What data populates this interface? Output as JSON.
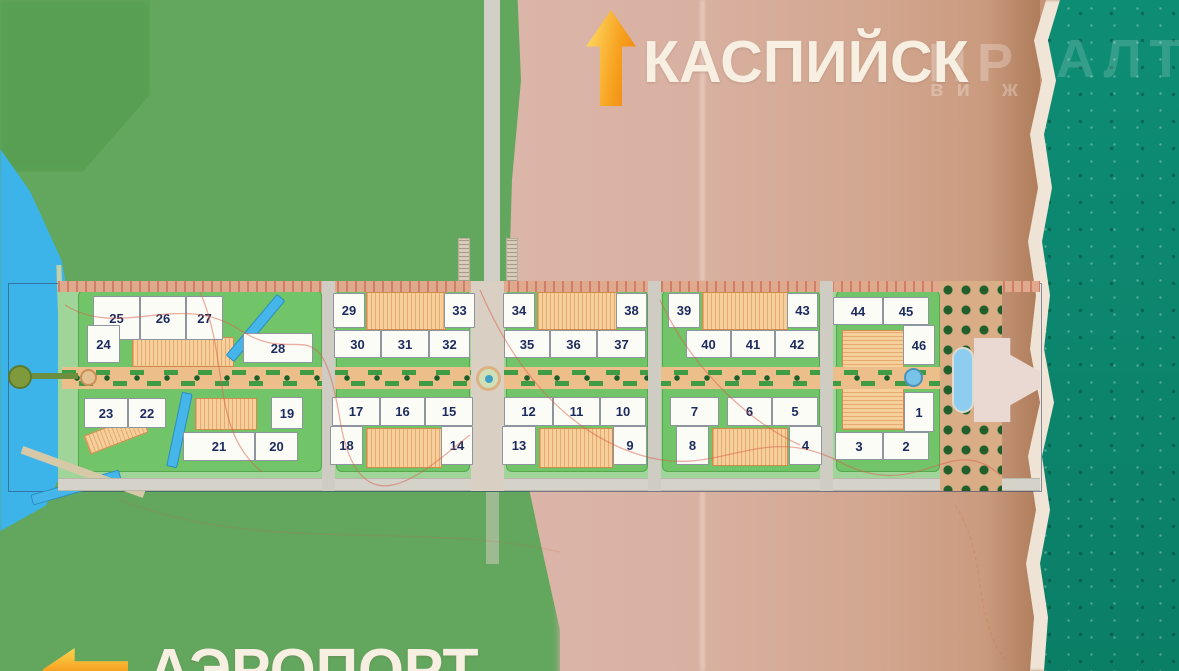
{
  "directions": {
    "north_label": "КАСПИЙСК",
    "south_label": "АЭРОПОРТ"
  },
  "watermark": {
    "part1": "НР",
    "part2": "АЛТ",
    "part3": "ви ж"
  },
  "colors": {
    "arrow_orange": "#f7941e",
    "label_text": "#f7f0e2",
    "number_navy": "#1c2a5e",
    "sea_teal": "#0d8570",
    "lake_cyan": "#3cb3e9",
    "grass_green": "#63a65e",
    "sand_pink": "#d9b1a2",
    "pad_green": "#72c468",
    "courtyard_tan": "#f6cf9b"
  },
  "plan": {
    "description": "seaside residential masterplan with numbered buildings",
    "building_count": 46,
    "buildings": [
      {
        "n": "25",
        "x": 93,
        "y": 296,
        "w": 47,
        "h": 44
      },
      {
        "n": "26",
        "x": 140,
        "y": 296,
        "w": 46,
        "h": 44
      },
      {
        "n": "27",
        "x": 186,
        "y": 296,
        "w": 37,
        "h": 44
      },
      {
        "n": "24",
        "x": 87,
        "y": 325,
        "w": 33,
        "h": 38
      },
      {
        "n": "28",
        "x": 243,
        "y": 333,
        "w": 70,
        "h": 30
      },
      {
        "n": "23",
        "x": 84,
        "y": 398,
        "w": 44,
        "h": 30
      },
      {
        "n": "22",
        "x": 128,
        "y": 398,
        "w": 38,
        "h": 30
      },
      {
        "n": "19",
        "x": 271,
        "y": 397,
        "w": 32,
        "h": 32
      },
      {
        "n": "21",
        "x": 183,
        "y": 432,
        "w": 72,
        "h": 29
      },
      {
        "n": "20",
        "x": 255,
        "y": 432,
        "w": 43,
        "h": 29
      },
      {
        "n": "29",
        "x": 333,
        "y": 293,
        "w": 32,
        "h": 35
      },
      {
        "n": "33",
        "x": 444,
        "y": 293,
        "w": 31,
        "h": 35
      },
      {
        "n": "30",
        "x": 334,
        "y": 330,
        "w": 47,
        "h": 28
      },
      {
        "n": "31",
        "x": 381,
        "y": 330,
        "w": 48,
        "h": 28
      },
      {
        "n": "32",
        "x": 429,
        "y": 330,
        "w": 41,
        "h": 28
      },
      {
        "n": "17",
        "x": 332,
        "y": 397,
        "w": 48,
        "h": 29
      },
      {
        "n": "16",
        "x": 380,
        "y": 397,
        "w": 45,
        "h": 29
      },
      {
        "n": "15",
        "x": 425,
        "y": 397,
        "w": 48,
        "h": 29
      },
      {
        "n": "18",
        "x": 330,
        "y": 426,
        "w": 33,
        "h": 39
      },
      {
        "n": "14",
        "x": 441,
        "y": 426,
        "w": 32,
        "h": 39
      },
      {
        "n": "34",
        "x": 503,
        "y": 293,
        "w": 32,
        "h": 35
      },
      {
        "n": "38",
        "x": 616,
        "y": 293,
        "w": 31,
        "h": 35
      },
      {
        "n": "35",
        "x": 504,
        "y": 330,
        "w": 46,
        "h": 28
      },
      {
        "n": "36",
        "x": 550,
        "y": 330,
        "w": 47,
        "h": 28
      },
      {
        "n": "37",
        "x": 597,
        "y": 330,
        "w": 49,
        "h": 28
      },
      {
        "n": "12",
        "x": 504,
        "y": 397,
        "w": 49,
        "h": 29
      },
      {
        "n": "11",
        "x": 553,
        "y": 397,
        "w": 47,
        "h": 29
      },
      {
        "n": "10",
        "x": 600,
        "y": 397,
        "w": 46,
        "h": 29
      },
      {
        "n": "13",
        "x": 502,
        "y": 426,
        "w": 34,
        "h": 39
      },
      {
        "n": "9",
        "x": 613,
        "y": 426,
        "w": 34,
        "h": 39
      },
      {
        "n": "39",
        "x": 668,
        "y": 293,
        "w": 32,
        "h": 35
      },
      {
        "n": "43",
        "x": 787,
        "y": 293,
        "w": 31,
        "h": 35
      },
      {
        "n": "40",
        "x": 686,
        "y": 330,
        "w": 45,
        "h": 28
      },
      {
        "n": "41",
        "x": 731,
        "y": 330,
        "w": 44,
        "h": 28
      },
      {
        "n": "42",
        "x": 775,
        "y": 330,
        "w": 44,
        "h": 28
      },
      {
        "n": "7",
        "x": 670,
        "y": 397,
        "w": 49,
        "h": 29
      },
      {
        "n": "6",
        "x": 727,
        "y": 397,
        "w": 45,
        "h": 29
      },
      {
        "n": "5",
        "x": 772,
        "y": 397,
        "w": 46,
        "h": 29
      },
      {
        "n": "8",
        "x": 676,
        "y": 426,
        "w": 33,
        "h": 39
      },
      {
        "n": "4",
        "x": 789,
        "y": 426,
        "w": 33,
        "h": 39
      },
      {
        "n": "44",
        "x": 833,
        "y": 297,
        "w": 50,
        "h": 28
      },
      {
        "n": "45",
        "x": 883,
        "y": 297,
        "w": 46,
        "h": 28
      },
      {
        "n": "46",
        "x": 903,
        "y": 325,
        "w": 32,
        "h": 40
      },
      {
        "n": "1",
        "x": 904,
        "y": 392,
        "w": 30,
        "h": 40
      },
      {
        "n": "3",
        "x": 835,
        "y": 432,
        "w": 48,
        "h": 28
      },
      {
        "n": "2",
        "x": 883,
        "y": 432,
        "w": 46,
        "h": 28
      }
    ]
  }
}
